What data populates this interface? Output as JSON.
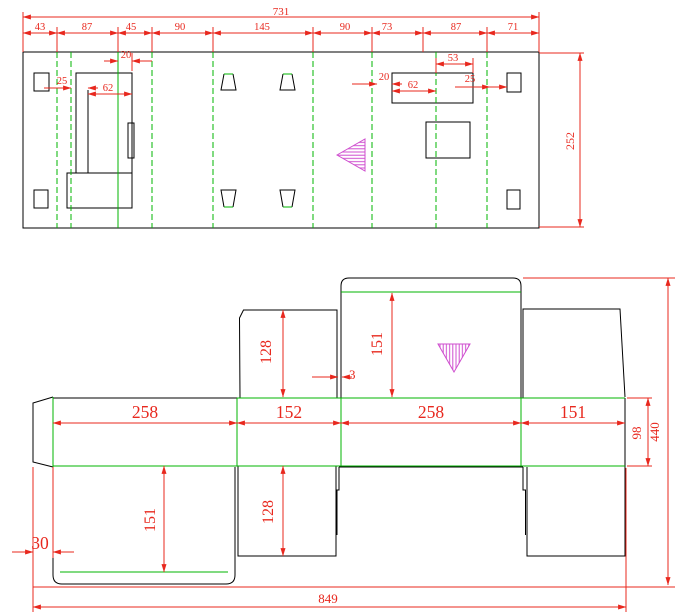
{
  "meta": {
    "colors": {
      "cut_line": "#000000",
      "fold_line": "#00b400",
      "dimension": "#e8281e",
      "hatch_mark": "#cf4fcf",
      "background": "#ffffff"
    }
  },
  "top_view": {
    "dim_total_width": "731",
    "dim_segments": [
      "43",
      "87",
      "45",
      "90",
      "145",
      "90",
      "73",
      "87",
      "71"
    ],
    "dim_height": "252",
    "dim_slot_offset_left": "20",
    "dim_gap_left": "25",
    "dim_slot_width_left": "62",
    "dim_slot_top_right": "53",
    "dim_slot_offset_right": "20",
    "dim_slot_width_right": "62",
    "dim_gap_right": "25"
  },
  "bottom_view": {
    "dim_panel_widths": [
      "258",
      "152",
      "258",
      "151"
    ],
    "dim_flap_top_small": "128",
    "dim_flap_top_large": "151",
    "dim_edge_gap": "3",
    "dim_band_height": "98",
    "dim_total_height": "440",
    "dim_flap_bottom_large": "151",
    "dim_flap_bottom_small": "128",
    "dim_left_strip": "30",
    "dim_total_width": "849"
  }
}
